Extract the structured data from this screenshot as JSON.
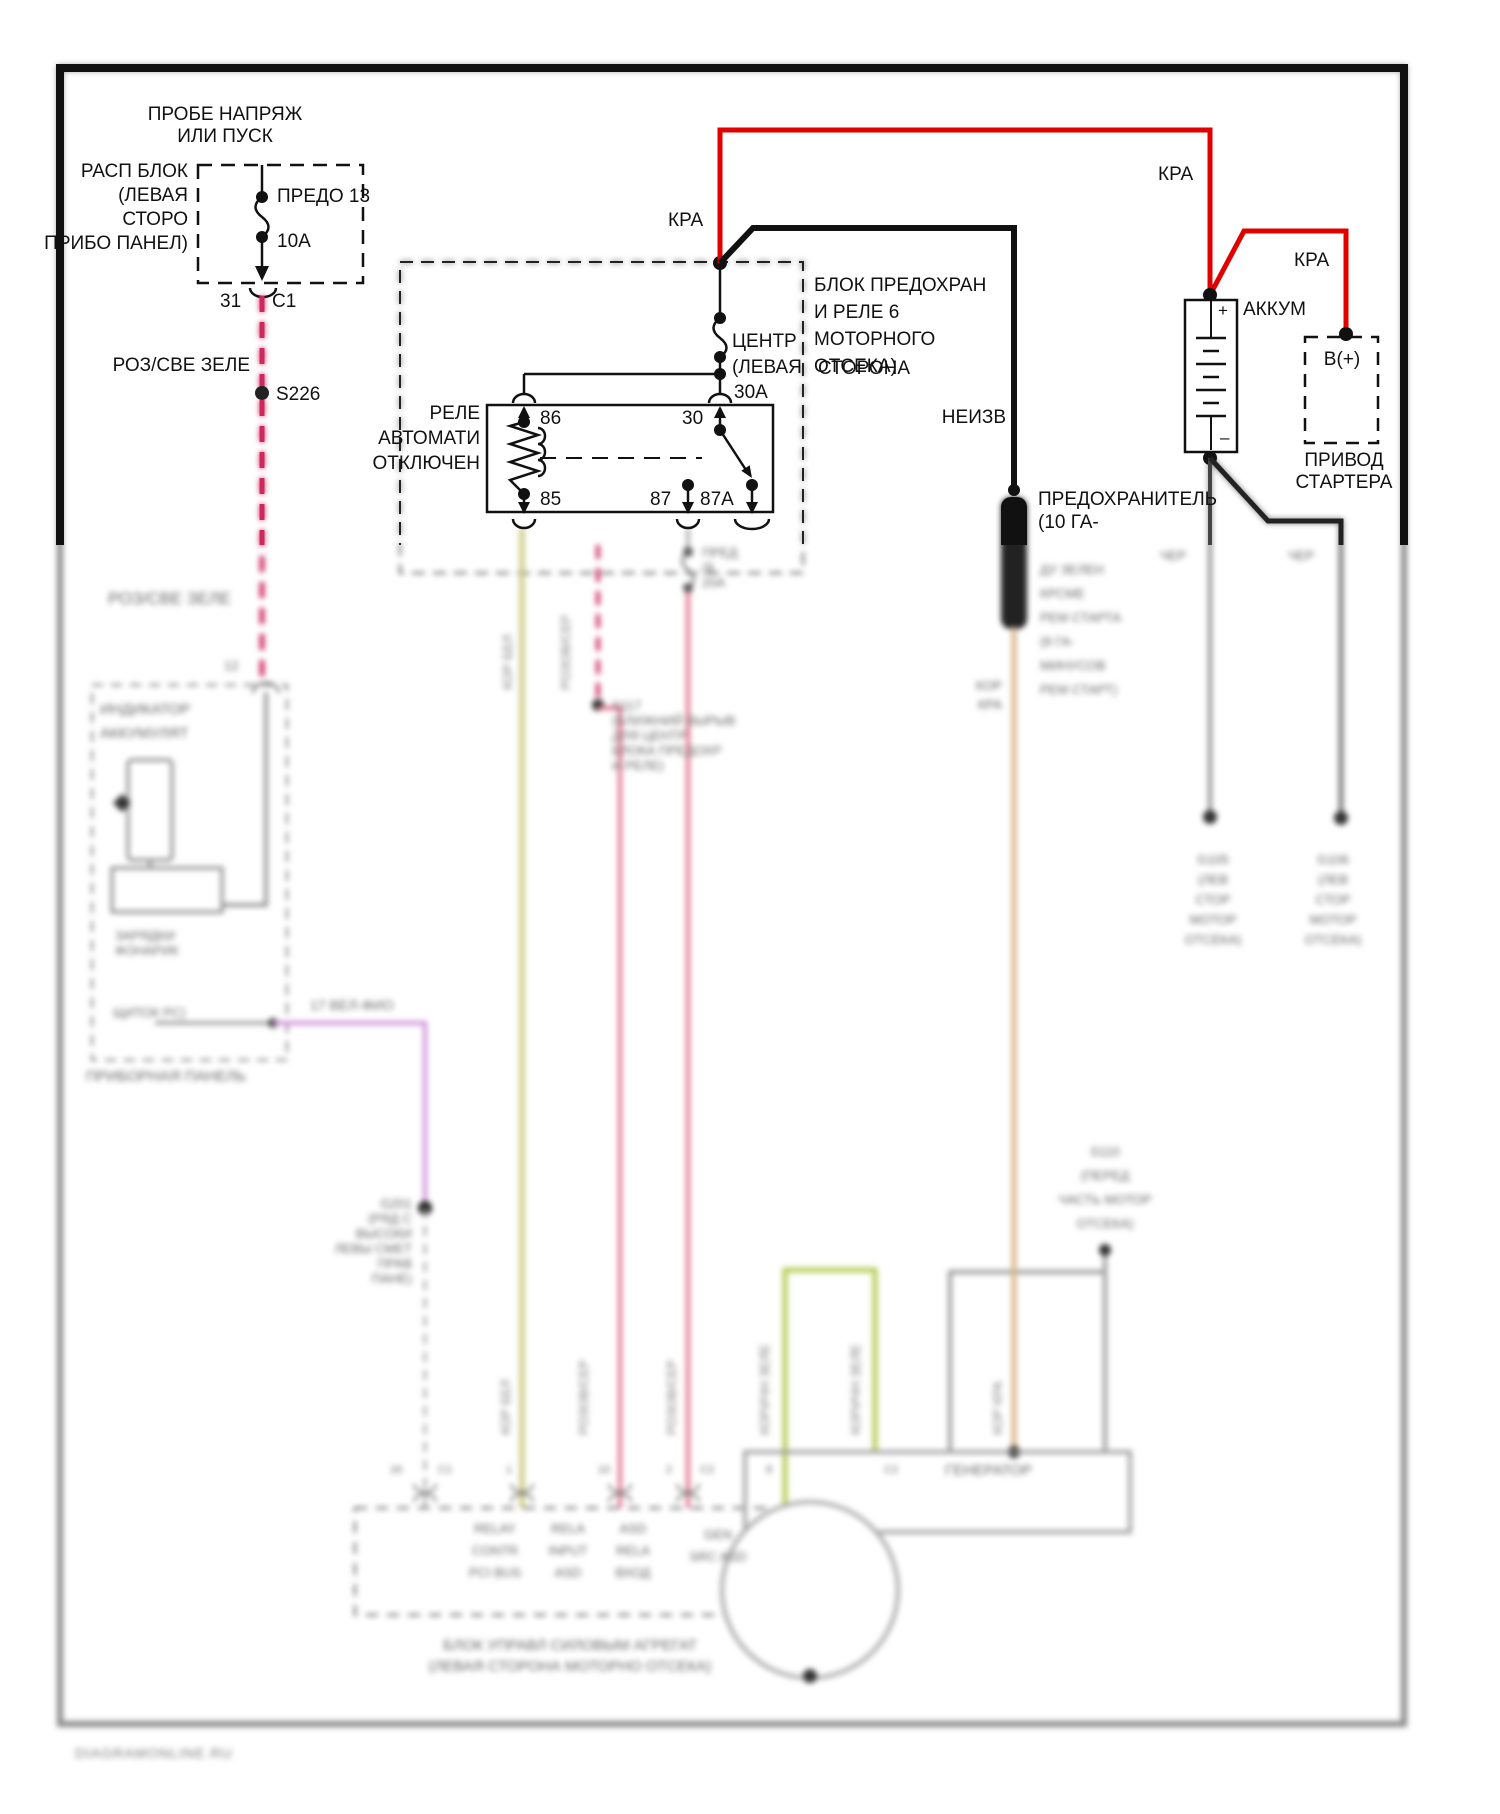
{
  "tl": {
    "caution": "ПРОБЕ НАПРЯЖ\nИЛИ ПУСК",
    "block": "РАСП БЛОК\n(ЛЕВАЯ\nСТОРО\nПРИБО ПАНЕЛ)",
    "fuse": "ПРЕДО 13",
    "amps": "10А",
    "pin": "31",
    "conn": "С1",
    "wire": "РОЗ/СВЕ ЗЕЛЕ",
    "splice": "S226"
  },
  "power": {
    "kpa": "КРА",
    "unknown": "НЕИЗВ"
  },
  "relay_block": {
    "title": "БЛОК ПРЕДОХРАН\nИ РЕЛЕ 6\nМОТОРНОГО\nОТСЕКА)",
    "fuse_name": "ЦЕНТР\n(ЛЕВАЯ",
    "fuse_name2": "СТОРОНА",
    "fuse_amps": "30А",
    "relay_name": "РЕЛЕ\nАВТОМАТИ\nОТКЛЮЧЕН",
    "pin86": "86",
    "pin30": "30",
    "pin85": "85",
    "pin87": "87",
    "pin87a": "87А"
  },
  "battery": {
    "label": "АККУМ",
    "plus": "+",
    "minus": "–"
  },
  "starter": {
    "terminal": "В(+)",
    "label": "ПРИВОД\nСТАРТЕРА"
  },
  "fusible": {
    "label": "ПРЕДОХРАНИТЕЛЬ\n(10 ГА-",
    "note": "ДУ ЗЕЛЕН\nКРСМЕ\nРЕМ СТАРТА\n(8 ГА-\nМИНУСОВ\nРЕМ СТАРТ)",
    "wire": "КОР\nКРА"
  },
  "grounds": {
    "w1": "ЧЕР",
    "w2": "ЧЕР",
    "g1": "G105\n(ЛЕВ\nСТОР\nМОТОР\nОТСЕКА)",
    "g2": "G106\n(ЛЕВ\nСТОР\nМОТОР\nОТСЕКА)",
    "g3": "G201\n(РЯД С\nВЫСОКИ\nЛЕВЫ СМЕТ\nПРАВ\nПАНЕ)",
    "s110": "S110\n(ПЕРЕД\nЧАСТЬ МОТОР\nОТСЕКА)"
  },
  "panel": {
    "wire": "РОЗ/СВЕ ЗЕЛЕ",
    "pin": "12",
    "title": "ИНДИКАТОР\nАККУМУЛЯТ",
    "sub": "ЗАРЯДКИ\nФОНАРИК",
    "sub2": "ЩИТОК РС)",
    "label": "ПРИБОРНАЯ ПАНЕЛЬ",
    "out": "17  ВЕЛ-ФИО"
  },
  "splices": {
    "s117": "S117\n(БЛИЖНИЙ ВЫРЫВ\nДЛЯ ЦЕНТР\nБЛОКА ПРЕДОХР\nИ РЕЛЕ)",
    "fuse87": "ПРЕД\n(8\n20А"
  },
  "wire_labels": {
    "korbel": "КОР БЕЛ",
    "rozser": "РОЗОВ/СЕР",
    "korzel": "КОРИЧН ЗЕЛЕ",
    "korkra": "КОР КРА"
  },
  "pins": {
    "p16": "16",
    "pc1": "С1",
    "p1": "1",
    "p10": "10",
    "p2": "2",
    "pc2": "С2",
    "p8": "8"
  },
  "pcm": {
    "col1": "RELAY\nCONTR\nPCI BUS",
    "col2": "RELA\nINPUT\nASD",
    "col3": "ASD\nRELA\nВХОД",
    "col4": "GEN\nSRC ASD",
    "caption": "БЛОК УПРАВЛ СИЛОВЫМ АГРЕГАТ\n(ЛЕВАЯ СТОРОНА МОТОРНО ОТСЕКА)"
  },
  "generator": {
    "label": "ГЕНЕРАТОР"
  },
  "watermark": "DIAGRAMONLINE.RU",
  "colors": {
    "red": "#e00000",
    "pink_dash": "#cc2a5e",
    "pink": "#e0708c",
    "khaki": "#c9c97e",
    "lime": "#b6cc55",
    "tan": "#d9b38c",
    "violet": "#cf8fd9",
    "grey": "#8a8a8a"
  }
}
